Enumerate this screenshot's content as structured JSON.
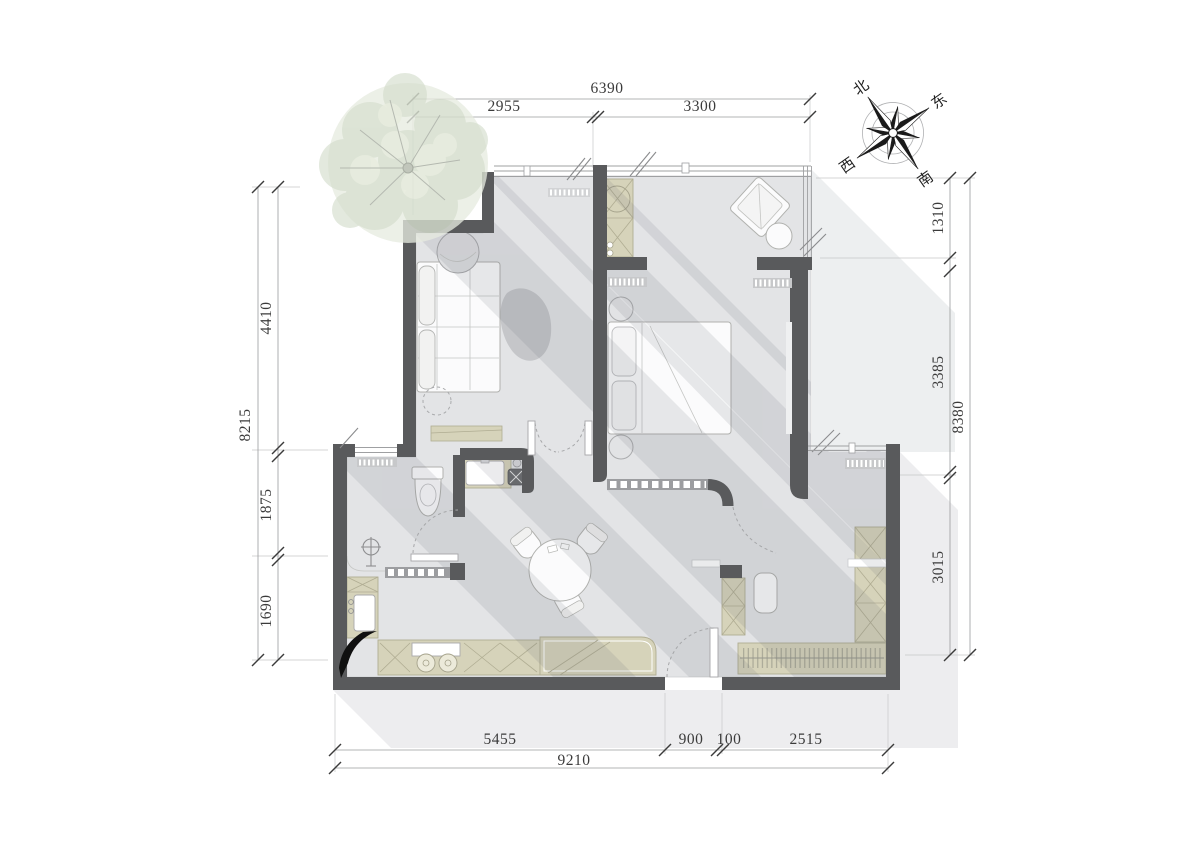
{
  "drawing": {
    "type": "apartment-floor-plan",
    "dimensions": {
      "top": {
        "total": "6390",
        "segments": [
          "2955",
          "3300"
        ]
      },
      "left": {
        "total": "8215",
        "segments": [
          "4410",
          "1875",
          "1690"
        ]
      },
      "right": {
        "total": "8380",
        "segments": [
          "1310",
          "3385",
          "3015"
        ]
      },
      "bottom": {
        "total": "9210",
        "segments": [
          "5455",
          "900",
          "100",
          "2515"
        ]
      }
    },
    "compass": {
      "north": "北",
      "east": "东",
      "south": "南",
      "west": "西"
    },
    "colors": {
      "wall": "#595a5c",
      "floor": "#e3e4e6",
      "cabinet": "#d6d3ba",
      "shadow_interior": "#d4d5d8",
      "shadow_exterior": "#ededef",
      "tree": "#ccd7c3",
      "dim_text": "#3b3b3b"
    }
  }
}
